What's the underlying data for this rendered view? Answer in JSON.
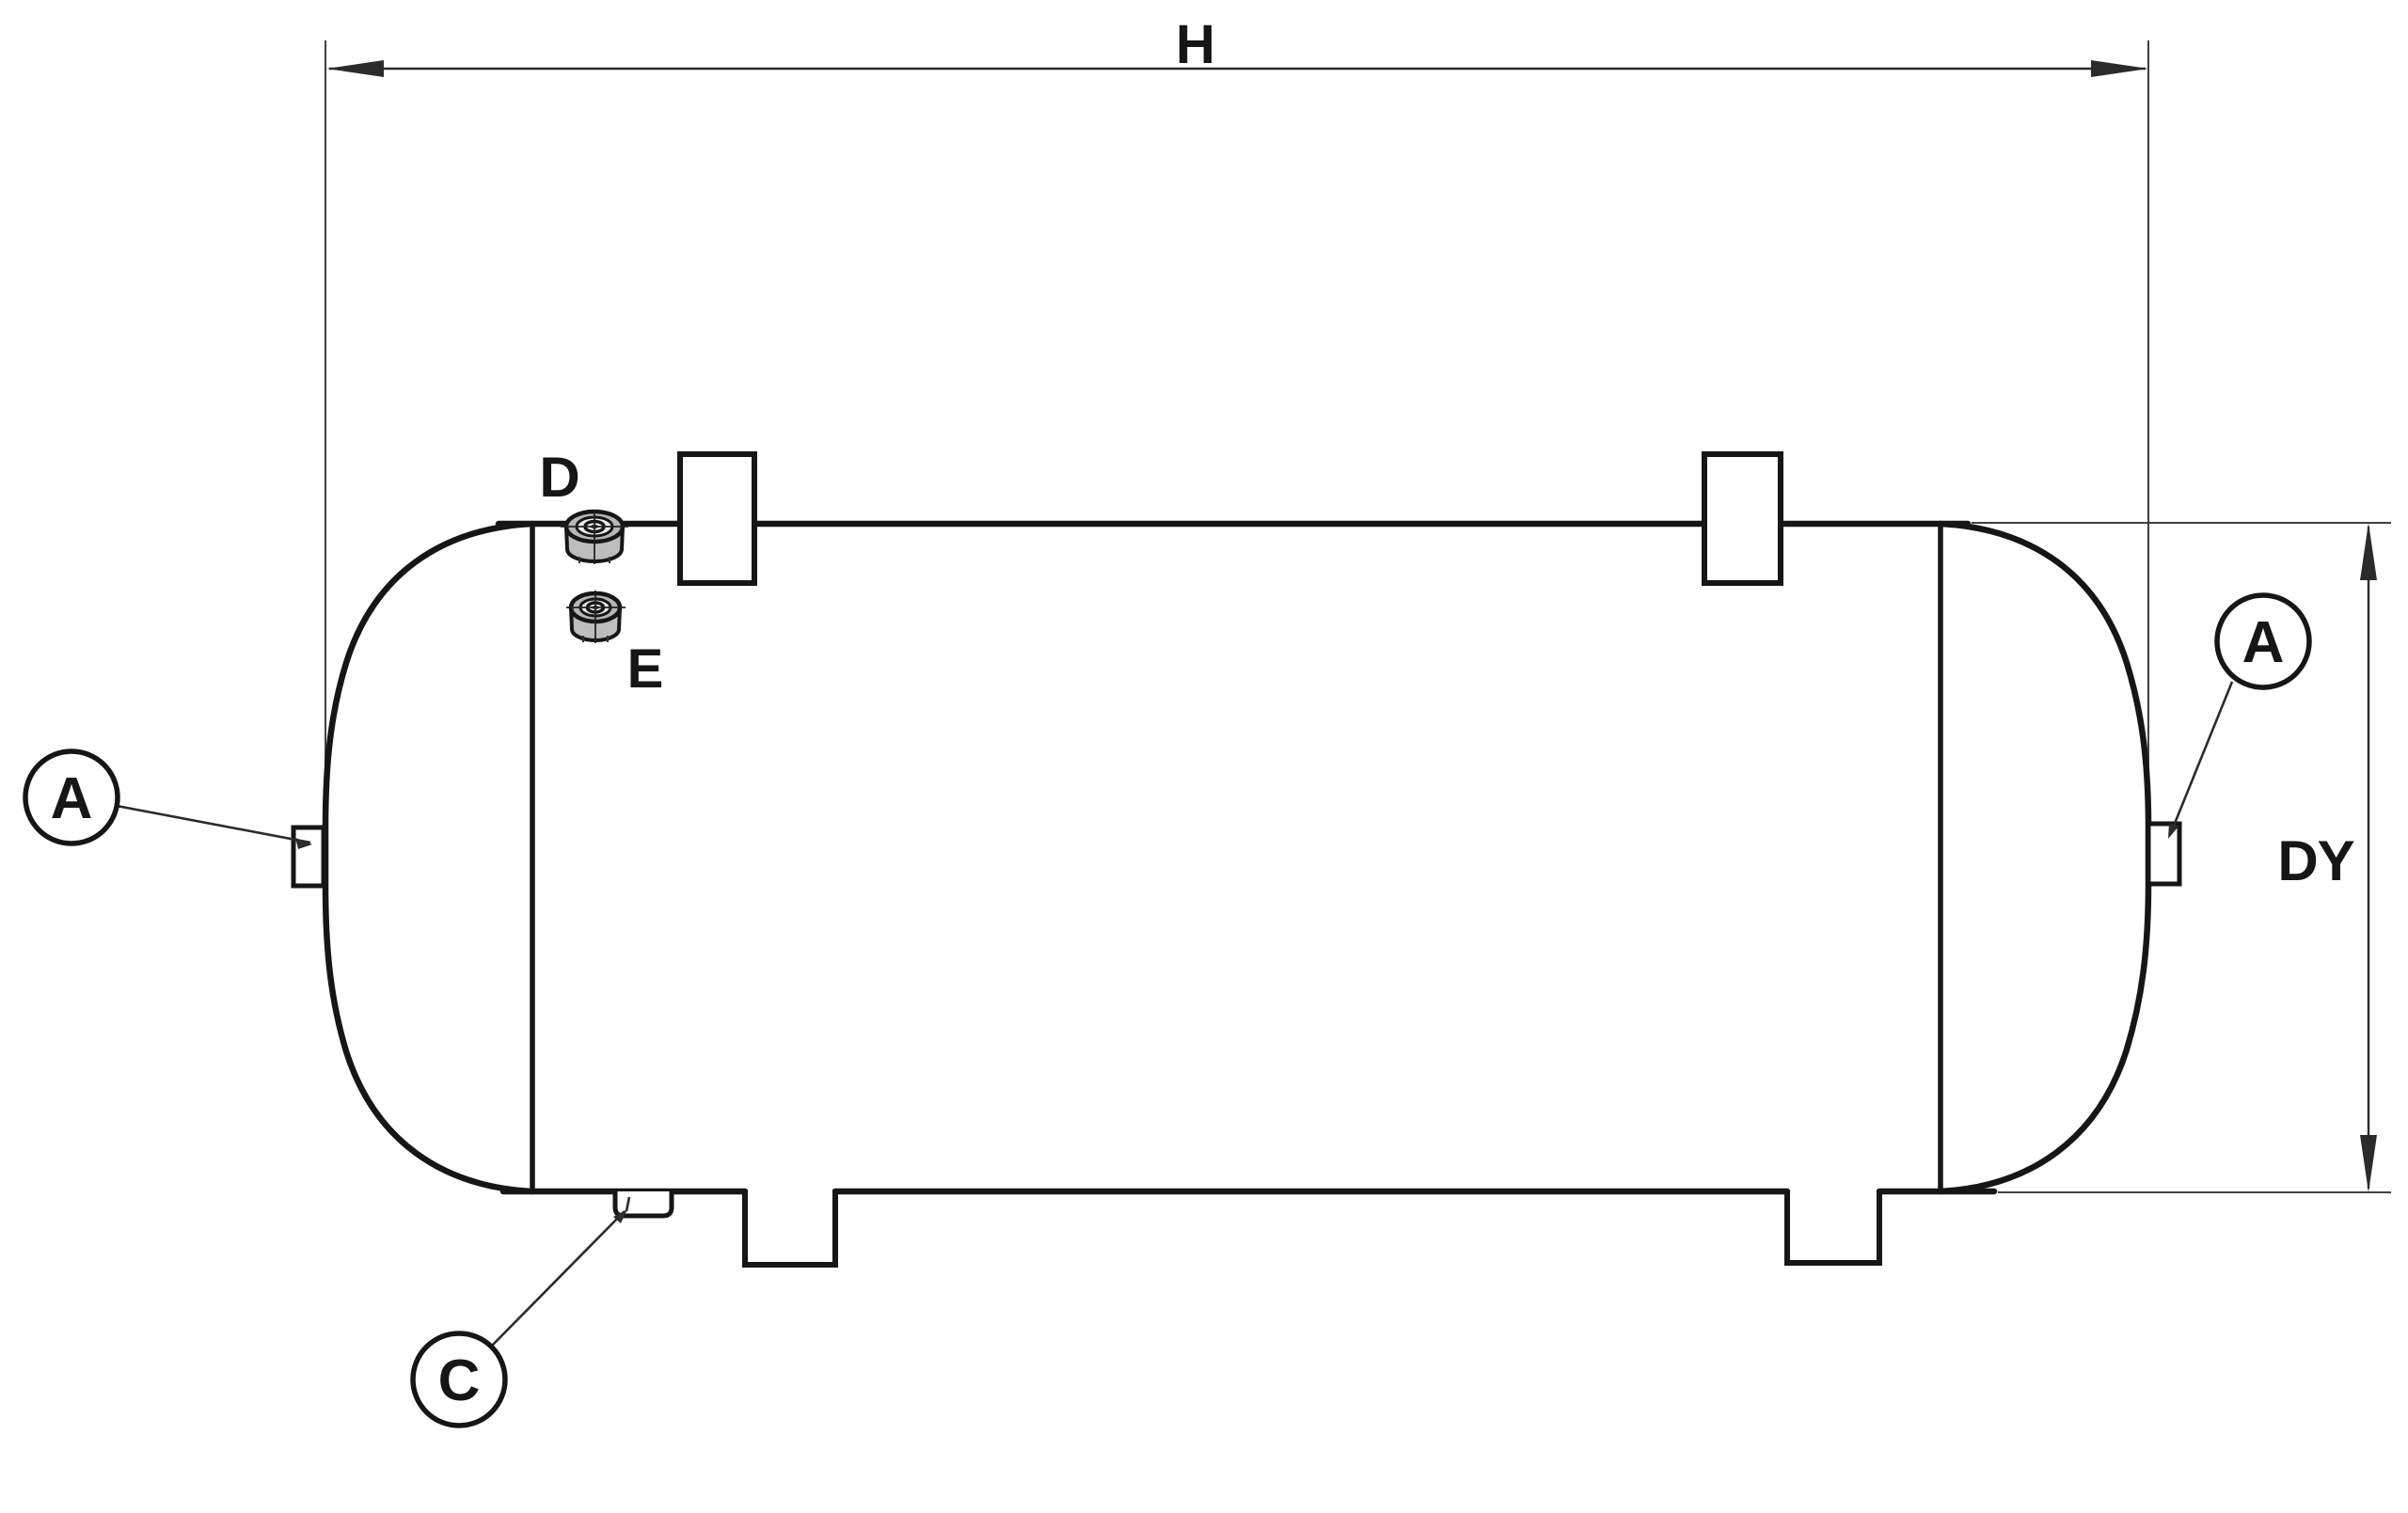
{
  "drawing": {
    "dimensions": {
      "h": {
        "label": "H"
      },
      "dy": {
        "label": "DY"
      }
    },
    "callouts": {
      "a_left": {
        "label": "A"
      },
      "a_right": {
        "label": "A"
      },
      "c": {
        "label": "C"
      }
    },
    "fittings": {
      "d": {
        "label": "D"
      },
      "e": {
        "label": "E"
      }
    },
    "colors": {
      "ink": "#161616",
      "dim": "#2b2b2b",
      "paper": "#ffffff",
      "fitting-ring": "#b6b6b6",
      "fitting-body": "#bdbdbd",
      "fitting-inner": "#ececec"
    }
  }
}
